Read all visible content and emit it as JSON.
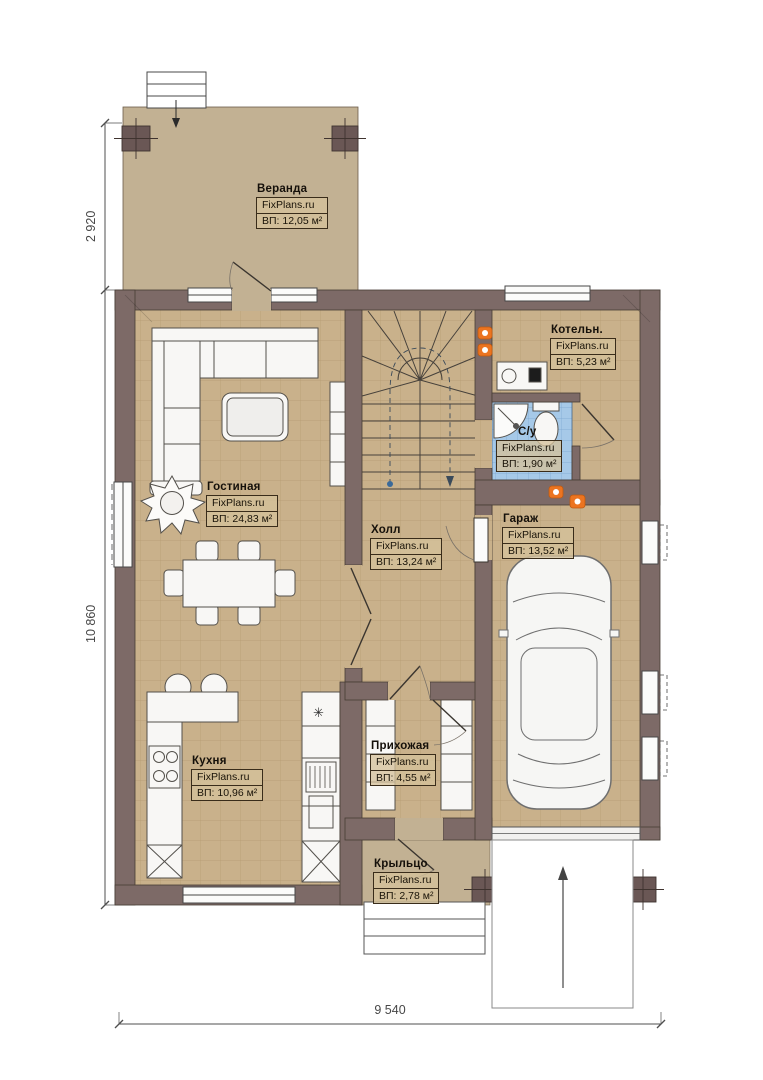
{
  "watermark": "FixPlans.ru",
  "rooms": {
    "veranda": {
      "name": "Веранда",
      "area": "ВП: 12,05 м²"
    },
    "gostinaya": {
      "name": "Гостиная",
      "area": "ВП: 24,83 м²"
    },
    "holl": {
      "name": "Холл",
      "area": "ВП: 13,24 м²"
    },
    "kotelnaya": {
      "name": "Котельн.",
      "area": "ВП: 5,23 м²"
    },
    "su": {
      "name": "С/у",
      "area": "ВП: 1,90 м²"
    },
    "garazh": {
      "name": "Гараж",
      "area": "ВП: 13,52 м²"
    },
    "kuhnya": {
      "name": "Кухня",
      "area": "ВП: 10,96 м²"
    },
    "prihozhaya": {
      "name": "Прихожая",
      "area": "ВП: 4,55 м²"
    },
    "kryltso": {
      "name": "Крыльцо",
      "area": "ВП: 2,78 м²"
    }
  },
  "dimensions": {
    "veranda_depth": "2 920",
    "house_depth": "10 860",
    "house_width": "9 540"
  },
  "symbols": {
    "freezer_star": "✳"
  },
  "colors": {
    "wall": "#7d6a67",
    "floor_tile": "#c9b18b",
    "veranda_floor": "#c2b193",
    "bathroom_tile": "#a6c9e8",
    "radiator": "#ec7420"
  }
}
